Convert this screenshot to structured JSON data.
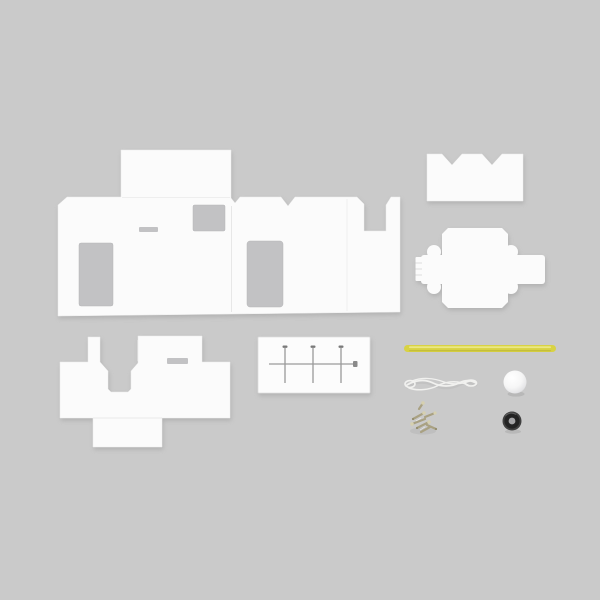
{
  "scene": {
    "description": "Flat-lay product photo of a DIY cardboard craft kit with parts arranged on a plain gray surface",
    "items": [
      {
        "name": "main-body-template",
        "label": "large white fold-out body template with window and slot cutouts"
      },
      {
        "name": "notched-roof-panel",
        "label": "small white panel with two V-notches on its top edge"
      },
      {
        "name": "box-fold-template",
        "label": "cross-shaped white box fold-out with side tabs and scalloped corners"
      },
      {
        "name": "base-fold-template",
        "label": "white base template with tab, slot and U-notch"
      },
      {
        "name": "axle-pin-card",
        "label": "white card holding three straight pins and one long axle rod"
      },
      {
        "name": "yellow-straw",
        "label": "yellow plastic straw / rod"
      },
      {
        "name": "string-cord",
        "label": "loop of thin white string"
      },
      {
        "name": "foam-ball",
        "label": "small white foam ball"
      },
      {
        "name": "screw-pile",
        "label": "pile of tiny brass screws"
      },
      {
        "name": "rubber-grommet",
        "label": "small black rubber grommet / tire with center hole"
      }
    ]
  },
  "colors": {
    "background": "#cacaca",
    "cardboard": "#fbfbfb",
    "card": "#fcfcfc",
    "cutout": "#c2c2c4",
    "fold_line": "#e7e7e7",
    "straw": "#d8d243",
    "straw_highlight": "#eeeb8e",
    "string": "#f1f1ef",
    "string_shadow": "#b8b8b8",
    "ball": "#ffffff",
    "ring_outer": "#404040",
    "ring_body": "#232323",
    "ring_hole": "#a4a4a6",
    "screw": "#a9a182",
    "screw_head": "#d6d0b0",
    "screw_dark": "#8f8868",
    "pin": "#9a9a9a",
    "pin_head": "#7a7a7a",
    "shadow": "#8f8f8f"
  }
}
